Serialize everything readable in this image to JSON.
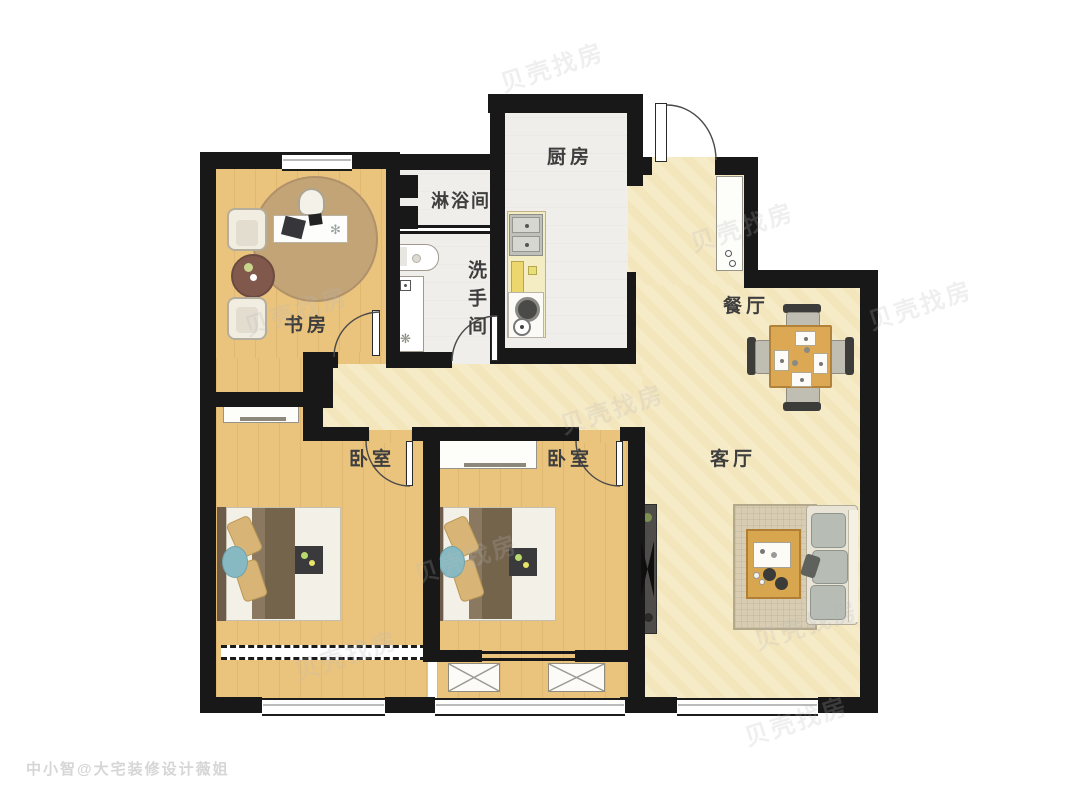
{
  "rooms": [
    {
      "id": "kitchen",
      "label": "厨房"
    },
    {
      "id": "shower",
      "label": "淋浴间"
    },
    {
      "id": "washroom",
      "label": "洗手间"
    },
    {
      "id": "study",
      "label": "书房"
    },
    {
      "id": "dining",
      "label": "餐厅"
    },
    {
      "id": "living",
      "label": "客厅"
    },
    {
      "id": "bedroom_left",
      "label": "卧室"
    },
    {
      "id": "bedroom_middle",
      "label": "卧室"
    }
  ],
  "watermark": {
    "brand": "贝壳找房",
    "credit": "中小智@大宅装修设计薇姐"
  },
  "colors": {
    "wall": "#181818",
    "wood_floor": "#eac47d",
    "tile_floor": "#f6ebc7",
    "light_floor": "#efeeea",
    "round_rug": "#c3a477",
    "furniture_wood": "#dca853",
    "duvet": "#7a6950",
    "pillow": "#d8b577",
    "accent_teal": "#86b9c1"
  }
}
